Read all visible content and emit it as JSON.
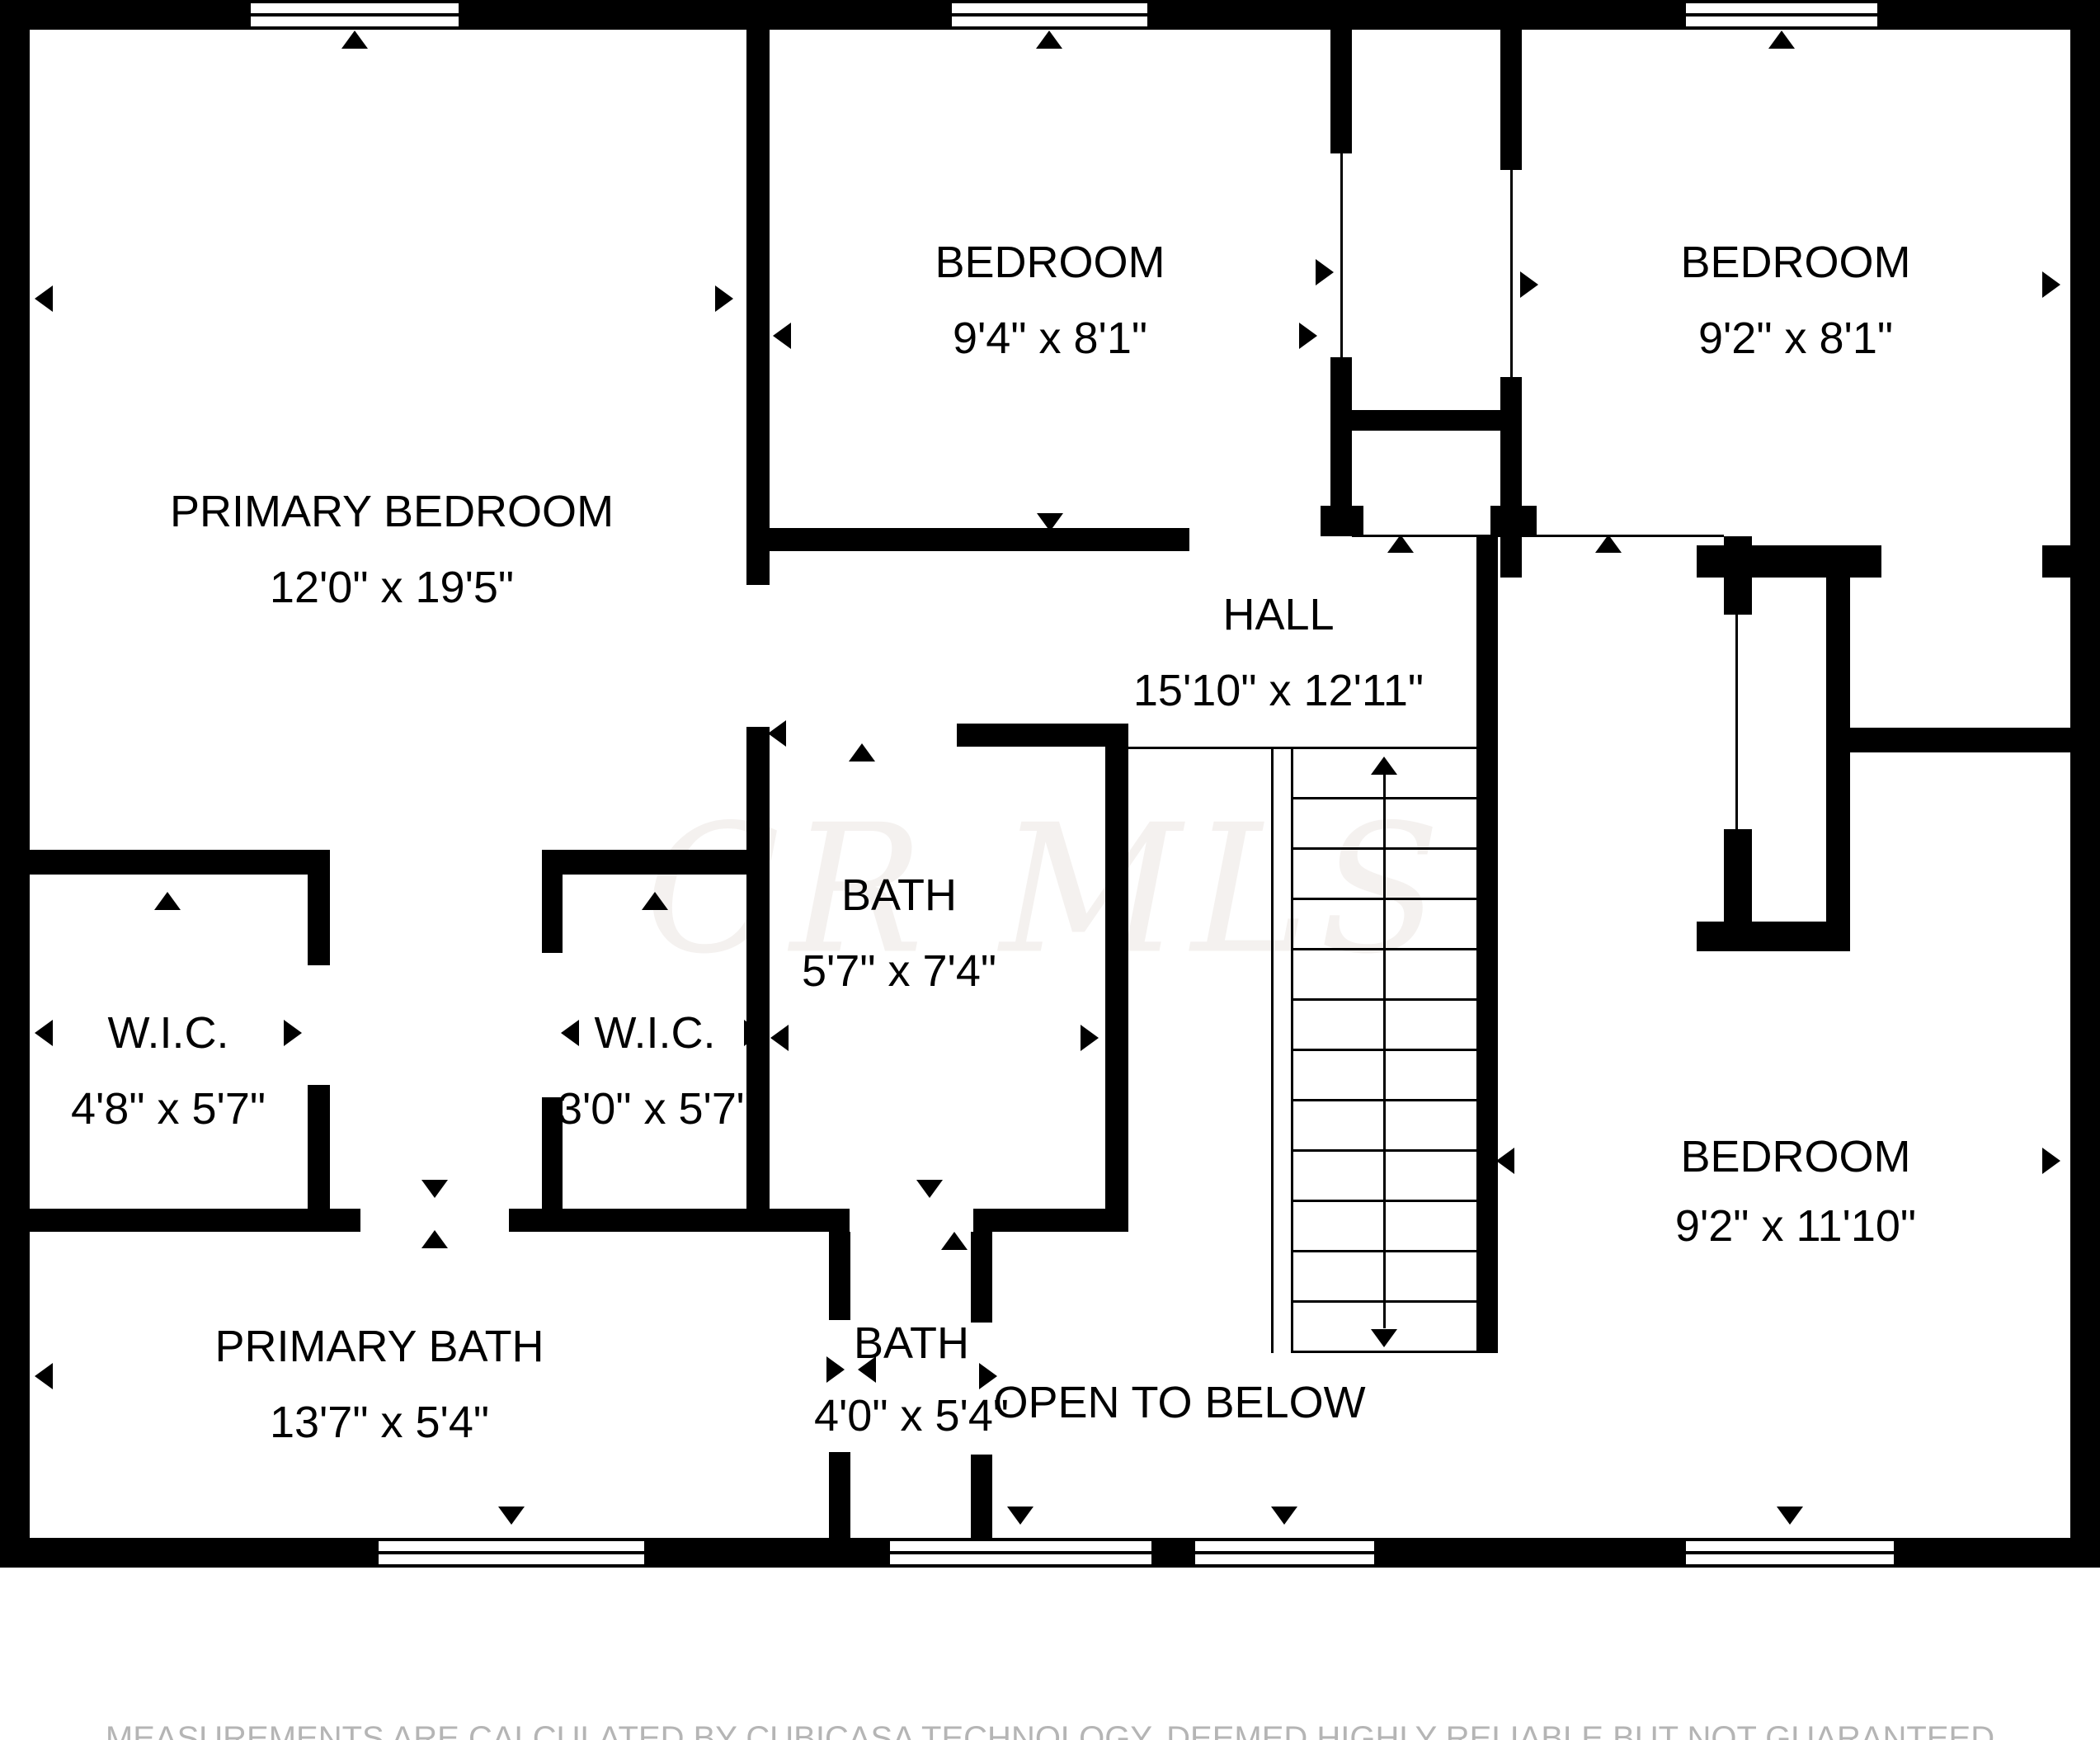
{
  "rooms": [
    {
      "name": "PRIMARY BEDROOM",
      "dims": "12'0\" x 19'5\""
    },
    {
      "name": "BEDROOM",
      "dims": "9'4\" x 8'1\""
    },
    {
      "name": "BEDROOM",
      "dims": "9'2\" x 8'1\""
    },
    {
      "name": "HALL",
      "dims": "15'10\" x 12'11\""
    },
    {
      "name": "BATH",
      "dims": "5'7\" x 7'4\""
    },
    {
      "name": "W.I.C.",
      "dims": "4'8\" x 5'7\""
    },
    {
      "name": "W.I.C.",
      "dims": "3'0\" x 5'7\""
    },
    {
      "name": "PRIMARY BATH",
      "dims": "13'7\" x 5'4\""
    },
    {
      "name": "BATH",
      "dims": "4'0\" x 5'4\""
    },
    {
      "name": "OPEN TO BELOW",
      "dims": ""
    },
    {
      "name": "BEDROOM",
      "dims": "9'2\" x 11'10\""
    }
  ],
  "watermark": "CR MLS",
  "disclaimer": "MEASUREMENTS ARE CALCULATED BY CUBICASA TECHNOLOGY. DEEMED HIGHLY RELIABLE BUT NOT GUARANTEED",
  "colors": {
    "wall": "#000000",
    "background": "#ffffff",
    "watermark": "#f4f1ef",
    "disclaimer": "#b5b5b5"
  }
}
